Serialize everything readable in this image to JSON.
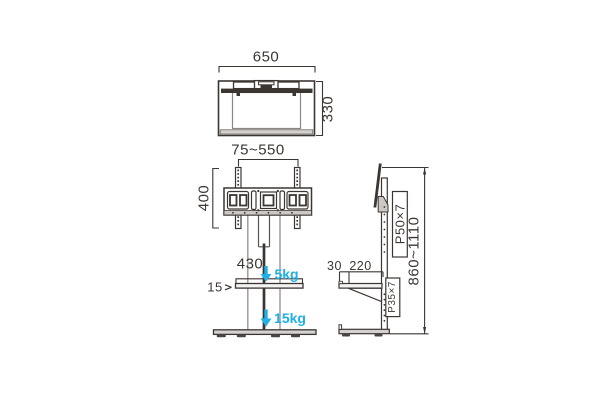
{
  "colors": {
    "line": "#3c3633",
    "accent": "#1fb0e5",
    "gray_fill": "#d4d1d0"
  },
  "views": {
    "top": {
      "width": "650",
      "depth": "330"
    },
    "front": {
      "vesa_width_range": "75~550",
      "bracket_height": "400",
      "shelf_width": "430",
      "shelf_thickness": "15",
      "shelf_load": "5kg",
      "base_load": "15kg"
    },
    "side": {
      "column_to_shelf_gap": "30",
      "shelf_depth": "220",
      "upper_hole_pitch": "P50×7",
      "lower_hole_pitch": "P35×7",
      "height_range": "860~1110"
    }
  }
}
